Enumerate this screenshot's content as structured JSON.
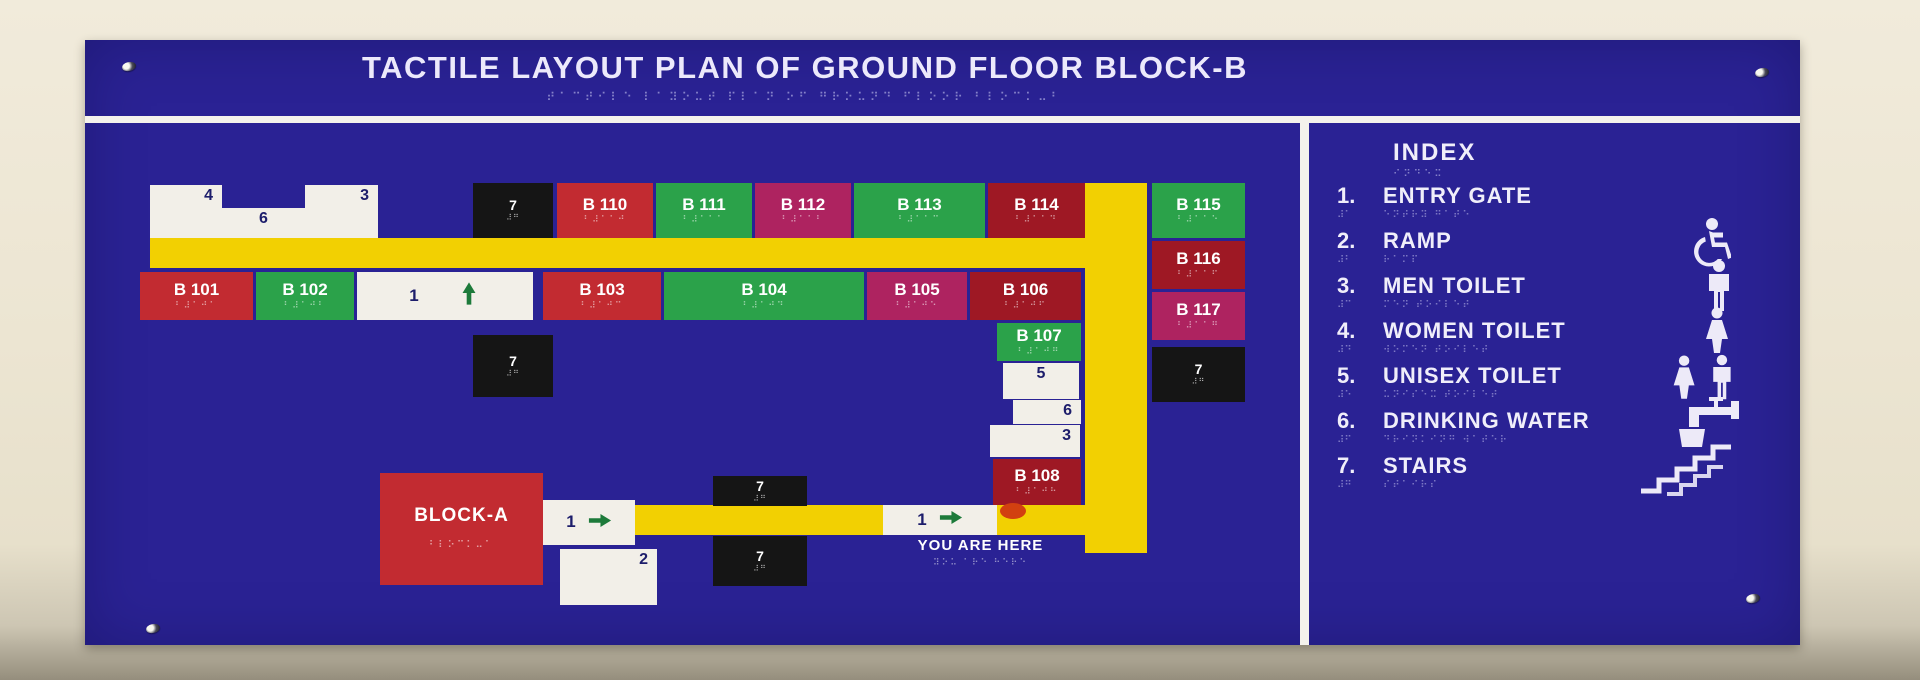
{
  "board": {
    "title": "TACTILE LAYOUT PLAN OF GROUND FLOOR BLOCK-B",
    "title_braille": "⠞⠁⠉⠞⠊⠇⠑ ⠇⠁⠽⠕⠥⠞ ⠏⠇⠁⠝ ⠕⠋ ⠛⠗⠕⠥⠝⠙ ⠋⠇⠕⠕⠗ ⠃⠇⠕⠉⠅⠤⠃"
  },
  "colors": {
    "board_blue": "#2a2294",
    "corridor_yellow": "#f2d002",
    "arrow_green": "#1d7a3a",
    "marker_red": "#d24010",
    "rooms": {
      "red": "#c22b31",
      "darkred": "#9e1824",
      "green": "#2ba24a",
      "magenta": "#ae2360",
      "black": "#151515",
      "white": "#f2efe8"
    }
  },
  "map": {
    "corridors": [
      {
        "name": "corridor-top",
        "x": 150,
        "y": 238,
        "w": 997,
        "h": 30
      },
      {
        "name": "corridor-vertical",
        "x": 1085,
        "y": 183,
        "w": 62,
        "h": 370
      },
      {
        "name": "corridor-bottom",
        "x": 635,
        "y": 505,
        "w": 450,
        "h": 30
      }
    ],
    "blocks": [
      {
        "name": "room-4",
        "kind": "num",
        "label": "4",
        "align": "right",
        "color": "white",
        "x": 150,
        "y": 185,
        "w": 72,
        "h": 53
      },
      {
        "name": "room-6",
        "kind": "num",
        "label": "6",
        "align": "center",
        "color": "white",
        "x": 222,
        "y": 208,
        "w": 83,
        "h": 30
      },
      {
        "name": "room-3",
        "kind": "num",
        "label": "3",
        "align": "right",
        "color": "white",
        "x": 305,
        "y": 185,
        "w": 73,
        "h": 53
      },
      {
        "name": "stairs-block-top",
        "kind": "seven",
        "label": "7",
        "braille": "⠼⠛",
        "color": "black",
        "x": 473,
        "y": 183,
        "w": 80,
        "h": 55
      },
      {
        "name": "room-b110",
        "kind": "room",
        "label": "B 110",
        "braille": "⠃⠼⠁⠁⠚",
        "color": "red",
        "x": 557,
        "y": 183,
        "w": 96,
        "h": 55
      },
      {
        "name": "room-b111",
        "kind": "room",
        "label": "B 111",
        "braille": "⠃⠼⠁⠁⠁",
        "color": "green",
        "x": 656,
        "y": 183,
        "w": 96,
        "h": 55
      },
      {
        "name": "room-b112",
        "kind": "room",
        "label": "B 112",
        "braille": "⠃⠼⠁⠁⠃",
        "color": "magenta",
        "x": 755,
        "y": 183,
        "w": 96,
        "h": 55
      },
      {
        "name": "room-b113",
        "kind": "room",
        "label": "B 113",
        "braille": "⠃⠼⠁⠁⠉",
        "color": "green",
        "x": 854,
        "y": 183,
        "w": 131,
        "h": 55
      },
      {
        "name": "room-b114",
        "kind": "room",
        "label": "B 114",
        "braille": "⠃⠼⠁⠁⠙",
        "color": "darkred",
        "x": 988,
        "y": 183,
        "w": 97,
        "h": 55
      },
      {
        "name": "room-b115",
        "kind": "room",
        "label": "B 115",
        "braille": "⠃⠼⠁⠁⠑",
        "color": "green",
        "x": 1152,
        "y": 183,
        "w": 93,
        "h": 55
      },
      {
        "name": "room-b116",
        "kind": "room",
        "label": "B 116",
        "braille": "⠃⠼⠁⠁⠋",
        "color": "darkred",
        "x": 1152,
        "y": 241,
        "w": 93,
        "h": 48
      },
      {
        "name": "room-b117",
        "kind": "room",
        "label": "B 117",
        "braille": "⠃⠼⠁⠁⠛",
        "color": "magenta",
        "x": 1152,
        "y": 292,
        "w": 93,
        "h": 48
      },
      {
        "name": "stairs-block-right",
        "kind": "seven",
        "label": "7",
        "braille": "⠼⠛",
        "color": "black",
        "x": 1152,
        "y": 347,
        "w": 93,
        "h": 55
      },
      {
        "name": "room-b101",
        "kind": "room",
        "label": "B 101",
        "braille": "⠃⠼⠁⠚⠁",
        "color": "red",
        "x": 140,
        "y": 272,
        "w": 113,
        "h": 48
      },
      {
        "name": "room-b102",
        "kind": "room",
        "label": "B 102",
        "braille": "⠃⠼⠁⠚⠃",
        "color": "green",
        "x": 256,
        "y": 272,
        "w": 98,
        "h": 48
      },
      {
        "name": "nav-1-up",
        "kind": "nav",
        "label": "1",
        "arrow": "up",
        "color": "white",
        "x": 357,
        "y": 272,
        "w": 176,
        "h": 48
      },
      {
        "name": "room-b103",
        "kind": "room",
        "label": "B 103",
        "braille": "⠃⠼⠁⠚⠉",
        "color": "red",
        "x": 543,
        "y": 272,
        "w": 118,
        "h": 48
      },
      {
        "name": "room-b104",
        "kind": "room",
        "label": "B 104",
        "braille": "⠃⠼⠁⠚⠙",
        "color": "green",
        "x": 664,
        "y": 272,
        "w": 200,
        "h": 48
      },
      {
        "name": "room-b105",
        "kind": "room",
        "label": "B 105",
        "braille": "⠃⠼⠁⠚⠑",
        "color": "magenta",
        "x": 867,
        "y": 272,
        "w": 100,
        "h": 48
      },
      {
        "name": "room-b106",
        "kind": "room",
        "label": "B 106",
        "braille": "⠃⠼⠁⠚⠋",
        "color": "darkred",
        "x": 970,
        "y": 272,
        "w": 111,
        "h": 48
      },
      {
        "name": "room-b107",
        "kind": "room",
        "label": "B 107",
        "braille": "⠃⠼⠁⠚⠛",
        "color": "green",
        "x": 997,
        "y": 323,
        "w": 84,
        "h": 38
      },
      {
        "name": "room-5",
        "kind": "num",
        "label": "5",
        "align": "center",
        "color": "white",
        "x": 1003,
        "y": 363,
        "w": 76,
        "h": 36
      },
      {
        "name": "room-6b",
        "kind": "num",
        "label": "6",
        "align": "right",
        "color": "white",
        "x": 1013,
        "y": 400,
        "w": 68,
        "h": 24
      },
      {
        "name": "room-3b",
        "kind": "num",
        "label": "3",
        "align": "right",
        "color": "white",
        "x": 990,
        "y": 425,
        "w": 90,
        "h": 32
      },
      {
        "name": "room-b108",
        "kind": "room",
        "label": "B 108",
        "braille": "⠃⠼⠁⠚⠓",
        "color": "darkred",
        "x": 993,
        "y": 459,
        "w": 88,
        "h": 46
      },
      {
        "name": "stairs-block-mid",
        "kind": "seven",
        "label": "7",
        "braille": "⠼⠛",
        "color": "black",
        "x": 473,
        "y": 335,
        "w": 80,
        "h": 62
      },
      {
        "name": "block-a",
        "kind": "blocka",
        "label": "BLOCK-A",
        "braille": "⠃⠇⠕⠉⠅⠤⠁",
        "color": "red",
        "x": 380,
        "y": 473,
        "w": 163,
        "h": 112
      },
      {
        "name": "nav-1-right",
        "kind": "nav",
        "label": "1",
        "arrow": "right",
        "color": "white",
        "x": 543,
        "y": 500,
        "w": 92,
        "h": 45
      },
      {
        "name": "room-2",
        "kind": "num",
        "label": "2",
        "align": "right",
        "color": "white",
        "x": 560,
        "y": 549,
        "w": 97,
        "h": 56
      },
      {
        "name": "stairs-block-bottom-upper",
        "kind": "seven",
        "label": "7",
        "braille": "⠼⠛",
        "color": "black",
        "x": 713,
        "y": 476,
        "w": 94,
        "h": 30
      },
      {
        "name": "stairs-block-bottom-lower",
        "kind": "seven",
        "label": "7",
        "braille": "⠼⠛",
        "color": "black",
        "x": 713,
        "y": 536,
        "w": 94,
        "h": 50
      },
      {
        "name": "nav-1-right-here",
        "kind": "nav",
        "label": "1",
        "arrow": "right",
        "color": "white",
        "x": 883,
        "y": 505,
        "w": 114,
        "h": 30
      }
    ],
    "marker": {
      "x": 1000,
      "y": 503,
      "w": 26,
      "h": 16
    },
    "you_are_here": {
      "label": "YOU ARE HERE",
      "braille": "⠽⠕⠥ ⠁⠗⠑ ⠓⠑⠗⠑"
    }
  },
  "index": {
    "heading": "INDEX",
    "heading_braille": "⠊⠝⠙⠑⠭",
    "items": [
      {
        "num": "1.",
        "num_braille": "⠼⠁",
        "label": "ENTRY GATE",
        "braille": "⠑⠝⠞⠗⠽ ⠛⠁⠞⠑",
        "icon": null
      },
      {
        "num": "2.",
        "num_braille": "⠼⠃",
        "label": "RAMP",
        "braille": "⠗⠁⠍⠏",
        "icon": "wheelchair"
      },
      {
        "num": "3.",
        "num_braille": "⠼⠉",
        "label": "MEN TOILET",
        "braille": "⠍⠑⠝ ⠞⠕⠊⠇⠑⠞",
        "icon": "man"
      },
      {
        "num": "4.",
        "num_braille": "⠼⠙",
        "label": "WOMEN TOILET",
        "braille": "⠺⠕⠍⠑⠝ ⠞⠕⠊⠇⠑⠞",
        "icon": "woman"
      },
      {
        "num": "5.",
        "num_braille": "⠼⠑",
        "label": "UNISEX TOILET",
        "braille": "⠥⠝⠊⠎⠑⠭ ⠞⠕⠊⠇⠑⠞",
        "icon": "unisex"
      },
      {
        "num": "6.",
        "num_braille": "⠼⠋",
        "label": "DRINKING WATER",
        "braille": "⠙⠗⠊⠝⠅⠊⠝⠛ ⠺⠁⠞⠑⠗",
        "icon": "drinking-water"
      },
      {
        "num": "7.",
        "num_braille": "⠼⠛",
        "label": "STAIRS",
        "braille": "⠎⠞⠁⠊⠗⠎",
        "icon": "stairs"
      }
    ]
  }
}
